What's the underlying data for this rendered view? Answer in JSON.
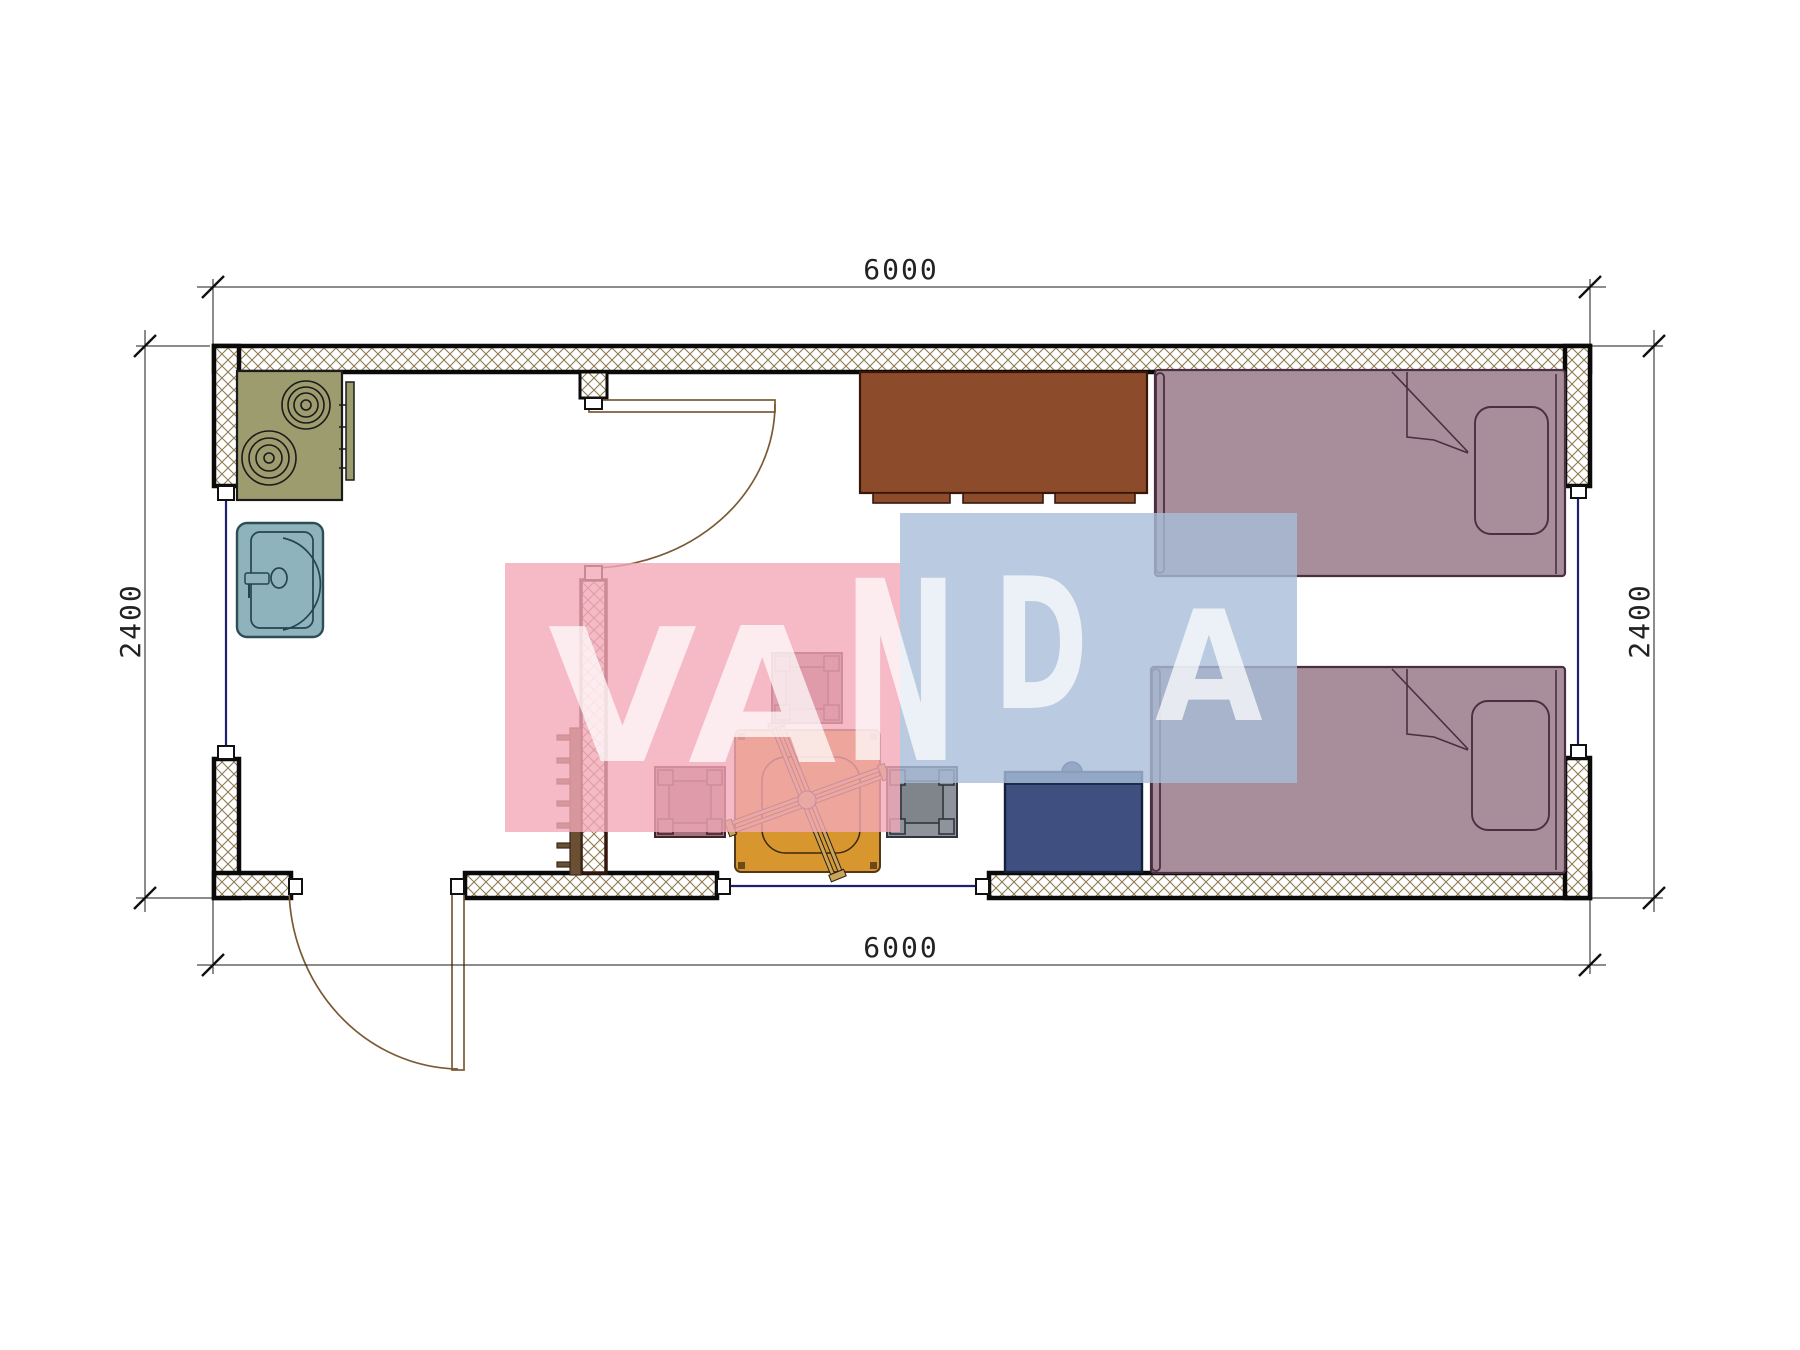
{
  "watermark": {
    "letters": [
      "V",
      "A",
      "N",
      "D",
      "A"
    ],
    "pink_color": "#f2a9b8",
    "blue_color": "#a9bdd8"
  },
  "dimensions": {
    "top": "6000",
    "bottom": "6000",
    "left": "2400",
    "right": "2400"
  },
  "colors": {
    "wall_hatch": "#8d7b50",
    "wall_outline": "#0a0a0a",
    "partition_outline": "#33170d",
    "stove": "#9c9c6e",
    "sink": "#8fb3bc",
    "cabinet": "#8c4b2b",
    "bed": "#a78e9a",
    "table": "#d8962f",
    "table_legs": "#c9a55c",
    "stool_mauve": "#a4737f",
    "stool_gray": "#8f939b",
    "armchair": "#3f5080",
    "window": "#202070",
    "door_arc": "#7a5a35",
    "coat_rack": "#6b4f33"
  },
  "symbols": [
    "stove-symbol",
    "sink-symbol",
    "cabinet-symbol",
    "single-bed-symbol",
    "single-bed-symbol",
    "square-table-symbol",
    "stool-symbol",
    "stool-symbol",
    "stool-symbol",
    "armchair-symbol",
    "coat-rack-symbol",
    "door-swing-symbol",
    "door-swing-symbol",
    "window-symbol",
    "window-symbol",
    "window-symbol"
  ]
}
